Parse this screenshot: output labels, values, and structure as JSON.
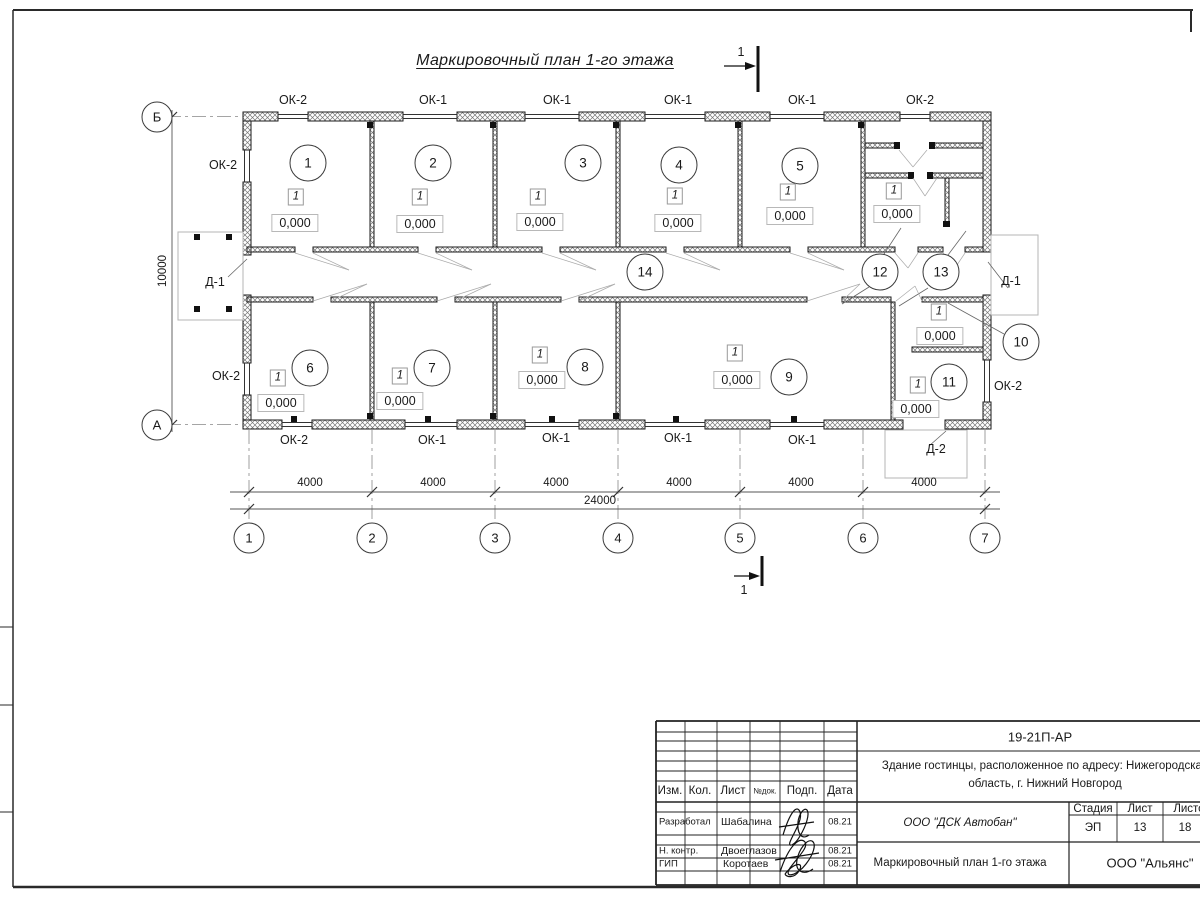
{
  "title": "Маркировочный план 1-го этажа",
  "plan": {
    "rooms": [
      "1",
      "2",
      "3",
      "4",
      "5",
      "6",
      "7",
      "8",
      "9",
      "10",
      "11",
      "12",
      "13",
      "14"
    ],
    "type_mark": "1",
    "level_mark": "0,000",
    "windows": {
      "ok1": "ОК-1",
      "ok2": "ОК-2"
    },
    "doors": {
      "d1": "Д-1",
      "d2": "Д-2"
    },
    "axes": {
      "cols": [
        "1",
        "2",
        "3",
        "4",
        "5",
        "6",
        "7"
      ],
      "rows": [
        "Б",
        "А"
      ]
    },
    "dims": {
      "bay": "4000",
      "total": "24000",
      "depth": "10000"
    },
    "section_label": "1"
  },
  "title_block": {
    "code": "19-21П-АР",
    "project_line1": "Здание гостинцы, расположенное по адресу: Нижегородская",
    "project_line2": "область, г. Нижний Новгород",
    "columns": {
      "izm": "Изм.",
      "kol": "Кол.",
      "list": "Лист",
      "ndok": "№док.",
      "podp": "Подп.",
      "data": "Дата"
    },
    "stage_header": "Стадия",
    "sheet_header": "Лист",
    "sheets_header": "Листов",
    "stage": "ЭП",
    "sheet": "13",
    "sheets": "18",
    "rows": [
      {
        "role": "Разработал",
        "name": "Шабалина",
        "date": "08.21"
      },
      {
        "role": "Н. контр.",
        "name": "Двоеглазов",
        "date": "08.21"
      },
      {
        "role": "ГИП",
        "name": "Коротаев",
        "date": "08.21"
      }
    ],
    "org": "ООО \"ДСК Автобан\"",
    "drawing_title": "Маркировочный план 1-го этажа",
    "company": "ООО \"Альянс\""
  }
}
